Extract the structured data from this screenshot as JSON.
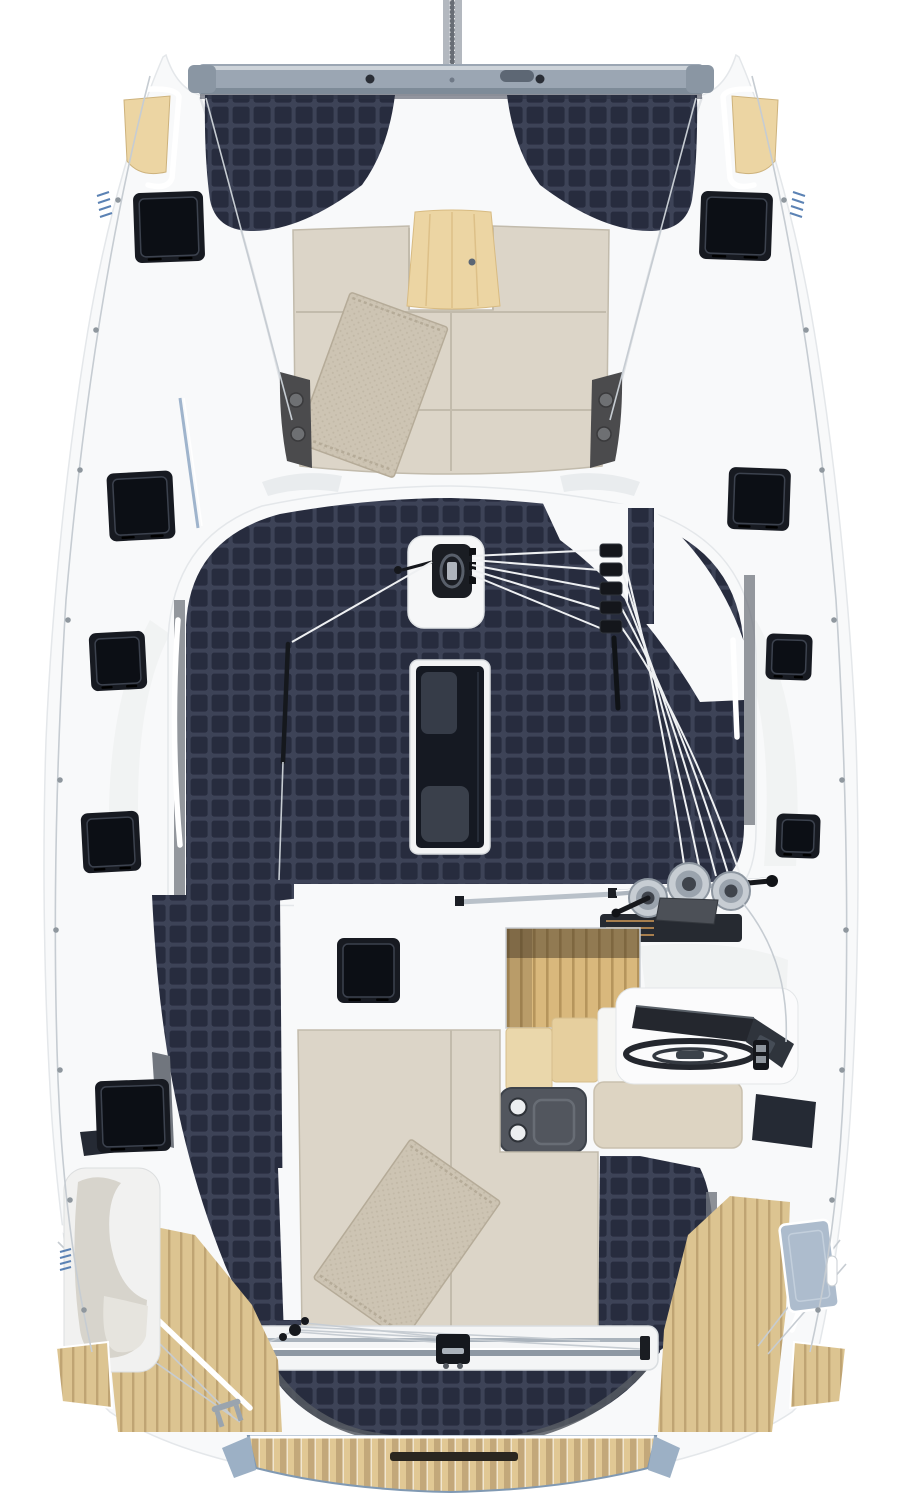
{
  "meta": {
    "title": "Catamaran deck plan - aerial 3D render",
    "description": "Top-down render of a solar-electric sailing catamaran: forward crossbeam with mast, solar trampolines, foredeck lounge with wood table and towel, solar-covered coachroof with skylight and halyard runs, starboard helm station with winches, aft sunpad with towel, mainsheet traveler, teak swim platform and transoms."
  },
  "palette": {
    "bg": "#ffffff",
    "hull": "#f8f9fa",
    "hull_line": "#e4e7ea",
    "deck_shadow": "#eceeef",
    "deck_shadow2": "#e0e3e6",
    "beam": "#9ba6b3",
    "beam_dark": "#7e8b98",
    "beam_cap": "#8a96a3",
    "mast": "#b3b8bf",
    "mast_core": "#686d75",
    "cell_bg": "#3d4357",
    "cell": "#272c3e",
    "trim": "#71767e",
    "trim_dark": "#565a62",
    "hatch_frame": "#171a21",
    "hatch_glass": "#0c0f15",
    "hatch_hi": "#3c424e",
    "glass": "#252a34",
    "cushion": "#dcd5c8",
    "cushion_seam": "#c2bbac",
    "towel": "#cdc4b3",
    "towel_line": "#b5ab98",
    "wood": "#ecd5a3",
    "wood_line": "#ddc088",
    "stair_wood": "#d9b87c",
    "stair_line": "#b6955c",
    "cabinet": "#ead7ab",
    "counter": "#f6f6f4",
    "teak": "#dcc491",
    "teak_line": "#bfa473",
    "swim_a": "#e1c894",
    "swim_b": "#c3a87a",
    "swim_trim": "#9cb0c5",
    "rope": "#eef0f2",
    "wire": "#c6ccd2",
    "rail": "#ffffff",
    "winch": "#c7cdd3",
    "winch_mid": "#9aa3ad",
    "winch_dark": "#3f444c",
    "helm": "#24272e",
    "helm2": "#2f343c",
    "pod": "#52565e",
    "bench": "#ddd4c2",
    "locker": "#adbccd",
    "stripe": "#5b82b4",
    "seat": "#d7d4cc"
  },
  "scene": {
    "hatches": [
      {
        "x": 134,
        "y": 192,
        "w": 70,
        "h": 70,
        "r": -2
      },
      {
        "x": 700,
        "y": 192,
        "w": 72,
        "h": 68,
        "r": 2
      },
      {
        "x": 108,
        "y": 472,
        "w": 66,
        "h": 68,
        "r": -3
      },
      {
        "x": 728,
        "y": 468,
        "w": 62,
        "h": 62,
        "r": 2
      },
      {
        "x": 90,
        "y": 632,
        "w": 56,
        "h": 58,
        "r": -3
      },
      {
        "x": 766,
        "y": 634,
        "w": 46,
        "h": 46,
        "r": 2
      },
      {
        "x": 82,
        "y": 812,
        "w": 58,
        "h": 60,
        "r": -3
      },
      {
        "x": 776,
        "y": 814,
        "w": 44,
        "h": 44,
        "r": 2
      },
      {
        "x": 96,
        "y": 1080,
        "w": 74,
        "h": 72,
        "r": -2
      },
      {
        "x": 337,
        "y": 938,
        "w": 63,
        "h": 65,
        "r": 0
      }
    ],
    "stanchions_left": [
      [
        118,
        200
      ],
      [
        96,
        330
      ],
      [
        80,
        470
      ],
      [
        68,
        620
      ],
      [
        60,
        780
      ],
      [
        56,
        930
      ],
      [
        60,
        1070
      ],
      [
        70,
        1200
      ],
      [
        84,
        1310
      ]
    ],
    "stanchions_right": [
      [
        784,
        200
      ],
      [
        806,
        330
      ],
      [
        822,
        470
      ],
      [
        834,
        620
      ],
      [
        842,
        780
      ],
      [
        846,
        930
      ],
      [
        842,
        1070
      ],
      [
        832,
        1200
      ],
      [
        818,
        1310
      ]
    ],
    "halyard_clutches": 5,
    "winches": 3
  }
}
